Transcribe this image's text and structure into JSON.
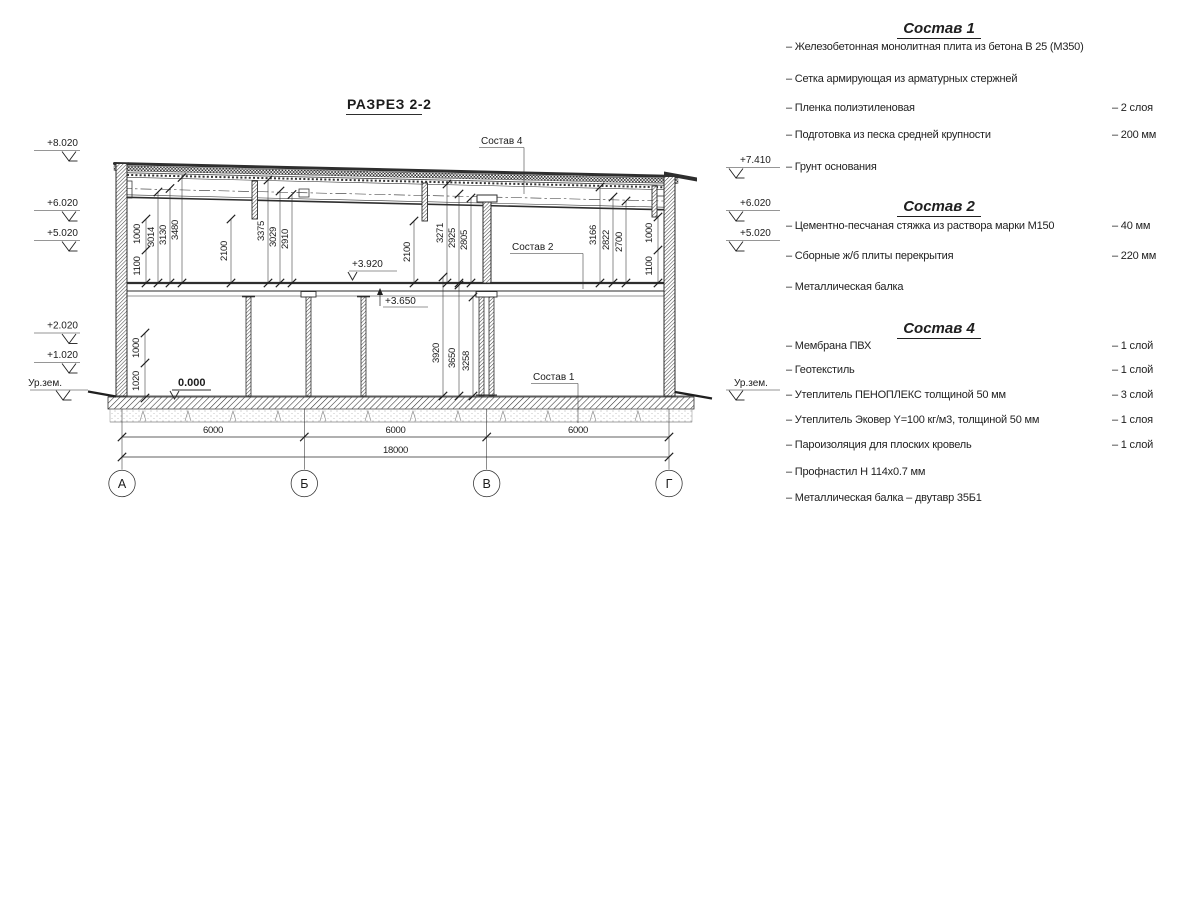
{
  "drawing": {
    "title": "РАЗРЕЗ 2-2",
    "elev_left": [
      "+8.020",
      "+6.020",
      "+5.020",
      "+2.020",
      "+1.020",
      "Ур.зем."
    ],
    "elev_right": [
      "+7.410",
      "+6.020",
      "+5.020",
      "Ур.зем."
    ],
    "marks": {
      "zero": "0.000",
      "m392": "+3.920",
      "m365": "+3.650"
    },
    "dims_u": [
      "1100",
      "1000",
      "3014",
      "3130",
      "3480",
      "2100",
      "3375",
      "3029",
      "2910",
      "2100",
      "3271",
      "2925",
      "2805",
      "3166",
      "2822",
      "2700",
      "1000",
      "1100"
    ],
    "dims_l": [
      "1020",
      "1000",
      "3920",
      "3650",
      "3258"
    ],
    "dims_b": [
      "6000",
      "6000",
      "6000",
      "18000"
    ],
    "axes": [
      "А",
      "Б",
      "В",
      "Г"
    ],
    "callouts": [
      "Состав 4",
      "Состав 2",
      "Состав 1"
    ]
  },
  "legend": {
    "sections": [
      {
        "title": "Состав 1",
        "items": [
          {
            "text": "– Железобетонная  монолитная плита из бетона В 25 (М350)",
            "value": ""
          },
          {
            "text": "– Сетка армирующая из арматурных стержней",
            "value": ""
          },
          {
            "text": "– Пленка полиэтиленовая",
            "value": "–  2 слоя"
          },
          {
            "text": "– Подготовка из песка средней крупности",
            "value": "– 200 мм"
          },
          {
            "text": "– Грунт основания",
            "value": ""
          }
        ]
      },
      {
        "title": "Состав 2",
        "items": [
          {
            "text": "– Цементно-песчаная стяжка из раствора марки М150",
            "value": "– 40 мм"
          },
          {
            "text": "– Сборные ж/б плиты перекрытия",
            "value": "– 220 мм"
          },
          {
            "text": "– Металлическая балка",
            "value": ""
          }
        ]
      },
      {
        "title": "Состав 4",
        "items": [
          {
            "text": "– Мембрана ПВХ",
            "value": "– 1 слой"
          },
          {
            "text": "– Геотекстиль",
            "value": "– 1 слой"
          },
          {
            "text": "– Утеплитель ПЕНОПЛЕКС толщиной 50 мм",
            "value": "– 3 слой"
          },
          {
            "text": "– Утеплитель Эковер Y=100 кг/м3, толщиной 50 мм",
            "value": "– 1 слоя"
          },
          {
            "text": "– Пароизоляция для плоских кровель",
            "value": "– 1 слой"
          },
          {
            "text": "– Профнастил Н 114х0.7 мм",
            "value": ""
          },
          {
            "text": "– Металлическая балка – двутавр 35Б1",
            "value": ""
          }
        ]
      }
    ]
  }
}
